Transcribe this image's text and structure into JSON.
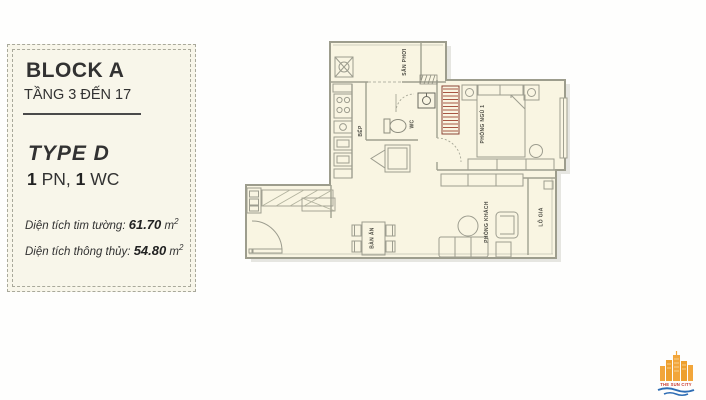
{
  "panel": {
    "block_title": "BLOCK A",
    "floor_range": "TẦNG 3 ĐẾN 17",
    "type_title": "TYPE D",
    "config": {
      "n1": "1",
      "u1": " PN, ",
      "n2": "1",
      "u2": " WC"
    },
    "area_wall": {
      "label": "Diện tích tim tường: ",
      "value": "61.70",
      "unit": " m",
      "sup": "2"
    },
    "area_net": {
      "label": "Diện tích thông thủy: ",
      "value": "54.80",
      "unit": " m",
      "sup": "2"
    }
  },
  "floorplan": {
    "labels": {
      "laundry": "SÂN PHƠI",
      "kitchen": "BẾP",
      "wc": "WC",
      "bedroom": "PHÒNG NGỦ 1",
      "dining": "BÀN ĂN",
      "living": "PHÒNG KHÁCH",
      "balcony": "LÔ GIA"
    }
  },
  "logo": {
    "name": "THE SUN CITY"
  },
  "colors": {
    "plan_bg": "#f9f5e2",
    "panel_bg": "#f8f6ea",
    "wall": "#a9a99b",
    "wardrobe_hatch": "#a85643",
    "logo_orange": "#f2a63b",
    "logo_red": "#c8382e",
    "logo_blue": "#2e6db4"
  }
}
